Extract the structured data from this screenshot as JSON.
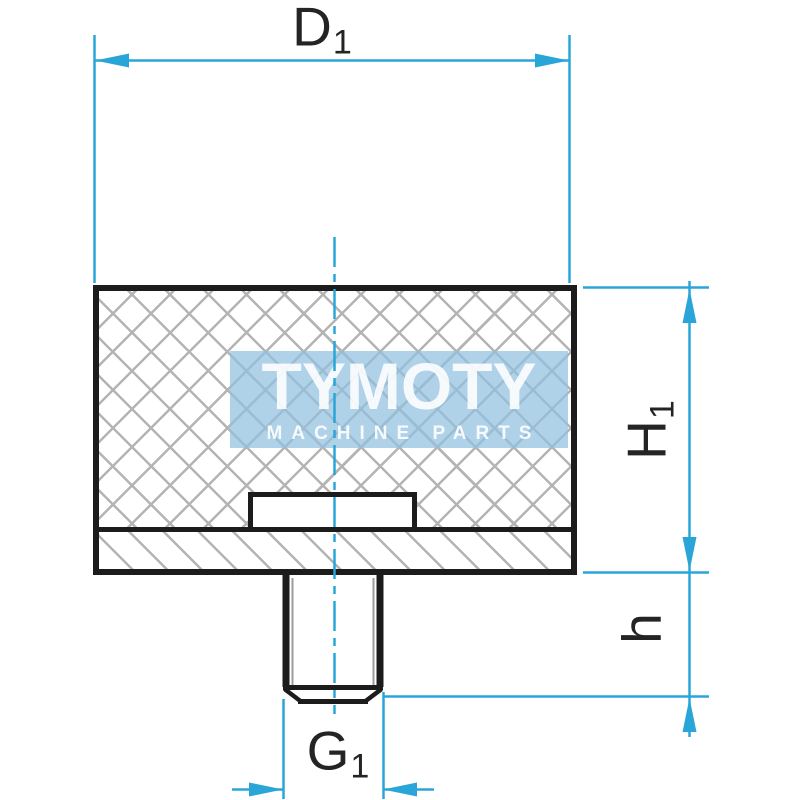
{
  "drawing": {
    "description": "rubber-buffer-technical-drawing",
    "dimensions": {
      "d1": {
        "main": "D",
        "sub": "1"
      },
      "h1": {
        "main": "H",
        "sub": "1"
      },
      "h": {
        "main": "h",
        "sub": ""
      },
      "g1": {
        "main": "G",
        "sub": "1"
      }
    },
    "watermark": {
      "title": "TYMOTY",
      "subtitle": "MACHINE PARTS"
    },
    "colors": {
      "dimension": "#2aa5d8",
      "outline": "#1c1c1c",
      "hatch": "#b4b4b4",
      "watermark_bg": "#b9d7ea",
      "watermark_text": "#ffffff"
    }
  }
}
